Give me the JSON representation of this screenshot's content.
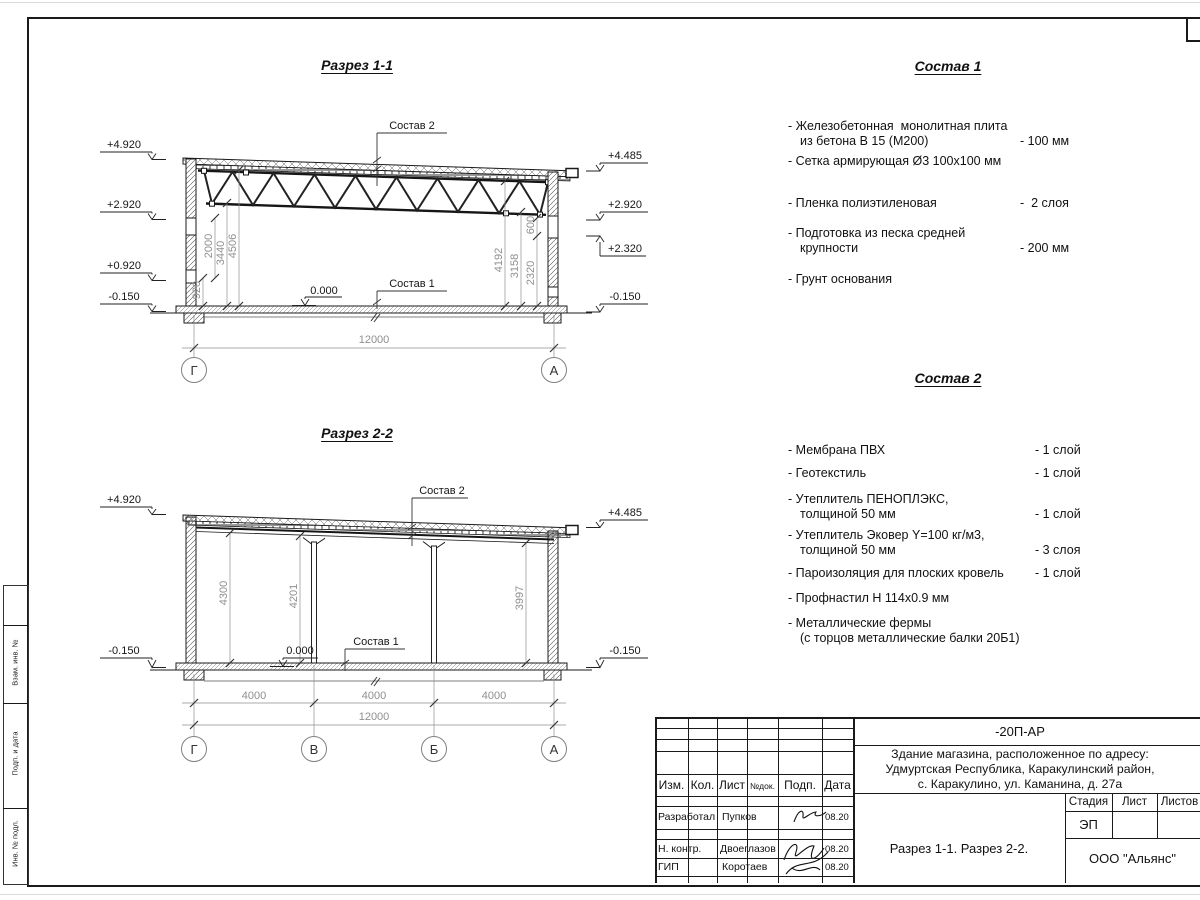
{
  "frame": {
    "side_labels": [
      "Взам. инв. №",
      "Подп. и дата",
      "Инв. № подл."
    ]
  },
  "section1": {
    "title": "Разрез 1-1",
    "callout_roof": "Состав 2",
    "callout_floor": "Состав 1",
    "zero": "0.000",
    "elev_left": [
      "+4.920",
      "+2.920",
      "+0.920",
      "-0.150"
    ],
    "elev_right": [
      "+4.485",
      "+2.920",
      "+2.320",
      "-0.150"
    ],
    "dims_left": [
      "920",
      "2000",
      "3440",
      "4506"
    ],
    "dims_right": [
      "4192",
      "3158",
      "2320",
      "600"
    ],
    "dim_total": "12000",
    "grid_left": "Г",
    "grid_right": "А"
  },
  "section2": {
    "title": "Разрез 2-2",
    "callout_roof": "Состав 2",
    "callout_floor": "Состав 1",
    "zero": "0.000",
    "elev_left": [
      "+4.920",
      "-0.150"
    ],
    "elev_right": [
      "+4.485",
      "-0.150"
    ],
    "dims_vert": [
      "4300",
      "4201",
      "3997"
    ],
    "dims_bottom": [
      "4000",
      "4000",
      "4000"
    ],
    "dim_total": "12000",
    "grid": [
      "Г",
      "В",
      "Б",
      "А"
    ]
  },
  "sostav1": {
    "title": "Состав 1",
    "items": [
      {
        "lines": [
          "- Железобетонная  монолитная плита",
          "из бетона В 15 (М200)"
        ],
        "value": "- 100 мм"
      },
      {
        "lines": [
          "- Сетка армирующая Ø3 100х100 мм"
        ],
        "value": ""
      },
      {
        "lines": [
          "- Пленка полиэтиленовая"
        ],
        "value": "-  2 слоя"
      },
      {
        "lines": [
          "- Подготовка из песка средней",
          "крупности"
        ],
        "value": "- 200 мм"
      },
      {
        "lines": [
          "- Грунт основания"
        ],
        "value": ""
      }
    ]
  },
  "sostav2": {
    "title": "Состав 2",
    "items": [
      {
        "lines": [
          "- Мембрана ПВХ"
        ],
        "value": "- 1 слой"
      },
      {
        "lines": [
          "- Геотекстиль"
        ],
        "value": "- 1 слой"
      },
      {
        "lines": [
          "- Утеплитель ПЕНОПЛЭКС,",
          "толщиной 50 мм"
        ],
        "value": "- 1 слой"
      },
      {
        "lines": [
          "- Утеплитель Эковер Y=100 кг/м3,",
          "толщиной 50 мм"
        ],
        "value": "- 3 слоя"
      },
      {
        "lines": [
          "- Пароизоляция для плоских кровель"
        ],
        "value": "- 1 слой"
      },
      {
        "lines": [
          "- Профнастил Н 114х0.9 мм"
        ],
        "value": ""
      },
      {
        "lines": [
          "- Металлические фермы",
          "(с торцов металлические балки 20Б1)"
        ],
        "value": ""
      }
    ]
  },
  "titleblock": {
    "code": "-20П-АР",
    "object_lines": [
      "Здание магазина, расположенное по адресу:",
      "Удмуртская Республика, Каракулинский район,",
      "с. Каракулино, ул. Каманина, д. 27а"
    ],
    "columns": [
      "Изм.",
      "Кол.",
      "Лист",
      "№док.",
      "Подп.",
      "Дата"
    ],
    "rows": [
      {
        "role": "Разработал",
        "name": "Пупков",
        "date": "08.20"
      },
      {
        "role": "Н. контр.",
        "name": "Двоеглазов",
        "date": "08.20"
      },
      {
        "role": "ГИП",
        "name": "Коротаев",
        "date": "08.20"
      }
    ],
    "stage_label": "Стадия",
    "sheet_label": "Лист",
    "sheets_label": "Листов",
    "stage": "ЭП",
    "doc_title": "Разрез 1-1. Разрез 2-2.",
    "company": "ООО \"Альянс\""
  }
}
